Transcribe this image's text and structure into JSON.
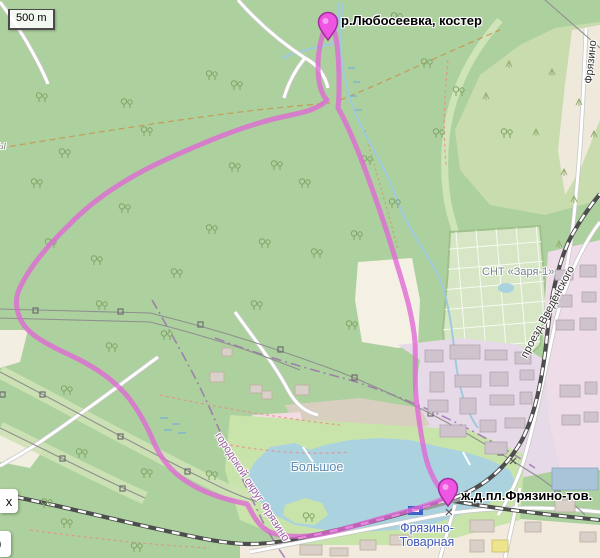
{
  "scale": {
    "label": "500 m"
  },
  "markers": {
    "river": {
      "label": "р.Любосеевка, костер"
    },
    "station": {
      "label": "ж.д.пл.Фрязино-тов."
    }
  },
  "places": {
    "snt": "СНТ «Заря-1»",
    "proezd": "проезд Введенского",
    "road_right": "Фрязино",
    "lake": "Большое",
    "station_line1": "Фрязино-",
    "station_line2": "Товарная",
    "district": "городской округ Фрязино",
    "edge_partial": "ы",
    "edge_box_1": "х",
    "edge_box_2": "0"
  },
  "icons": {
    "marker_pin": "map-pin",
    "trees": "deciduous-tree-pair",
    "tufts": "grass-tuft"
  },
  "colors": {
    "track": "#e066d6",
    "marker_fill": "#ee55e2",
    "marker_stroke": "#a32d9e",
    "forest": "#add19e",
    "scrub": "#c9dcae",
    "allotment": "#d7e6c5",
    "urban_pink": "#eedce8",
    "industrial": "#e7dae8",
    "town_beige": "#f1eadd",
    "field": "#f4f0e3",
    "lake": "#aad3df",
    "grass": "#c9e4aa",
    "bare": "#d9cfc0",
    "rail": "#4d4d4d"
  }
}
